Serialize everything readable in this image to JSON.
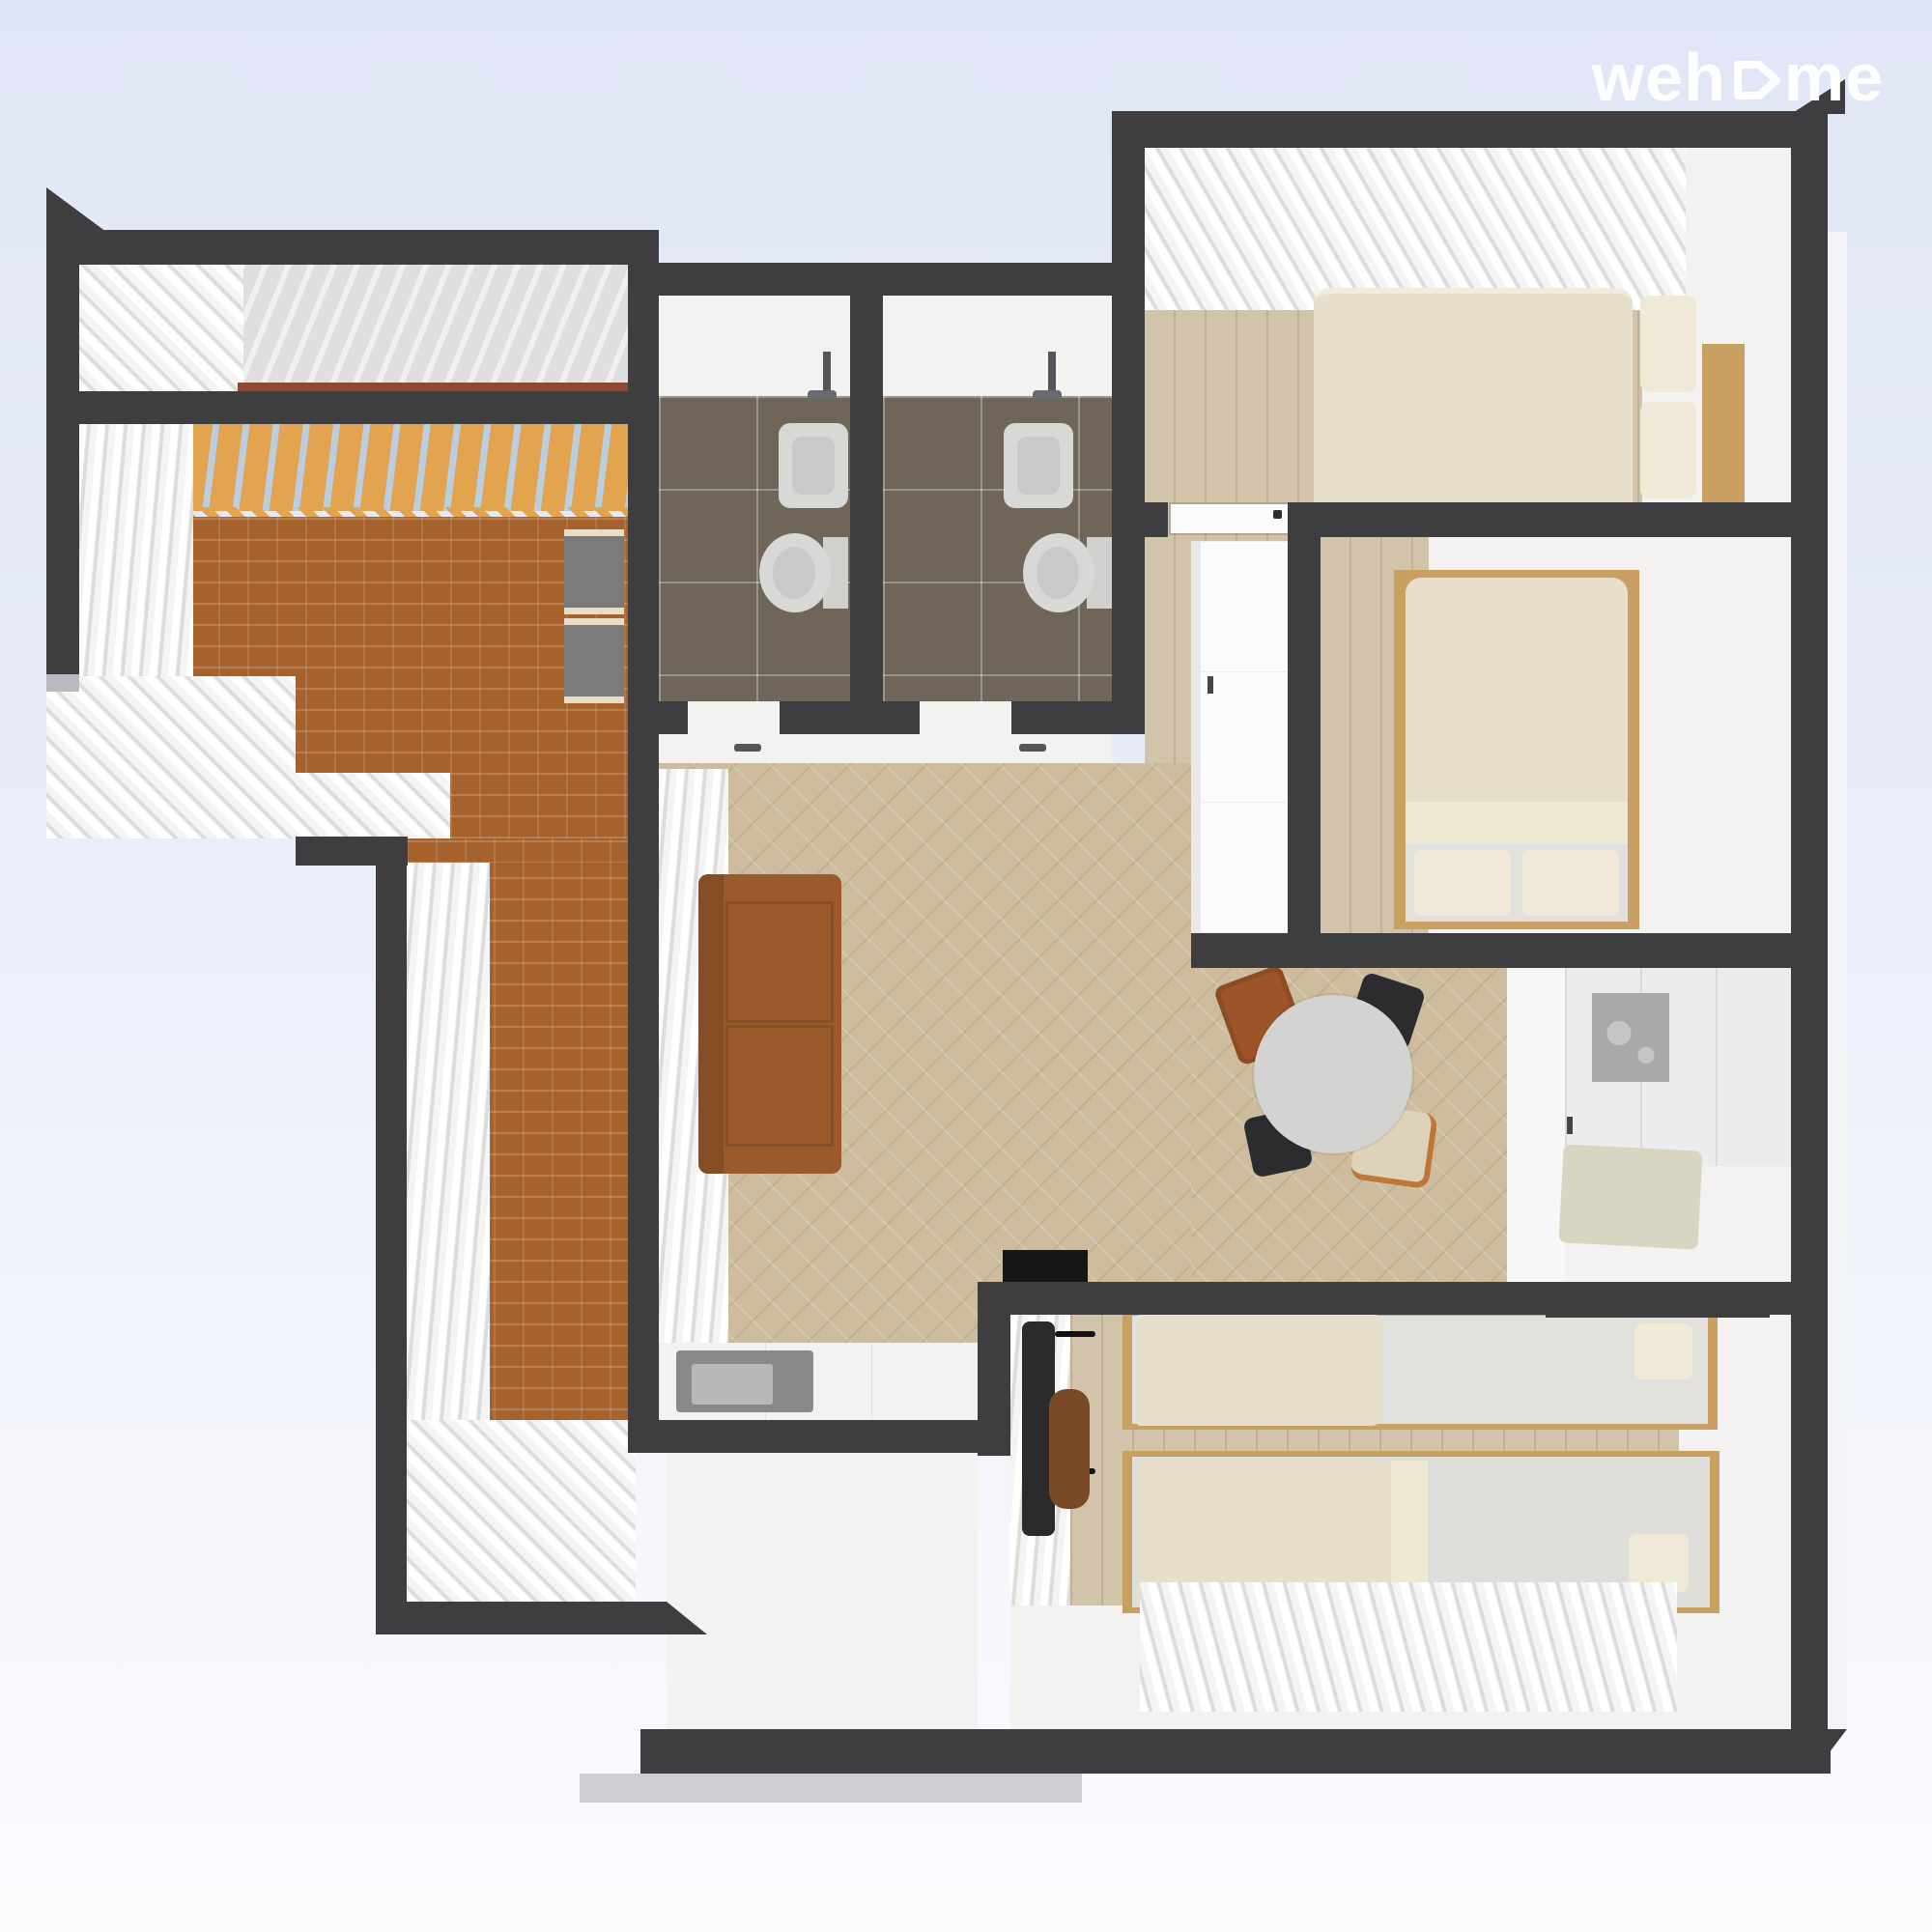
{
  "logo": {
    "part1": "weh",
    "part2": "me"
  },
  "palette": {
    "bg-top": "#e1e6f6",
    "bg-bottom": "#fbfcfe",
    "logo": "#ffffff",
    "wall": "#3e3e41",
    "wall-light": "#b9bac1",
    "floor-white": "#f3f2f0",
    "floor-gray": "#dfdfdf",
    "wood": "#d2c4ab",
    "herringbone": "#cdbd9e",
    "brick": "#a5622c",
    "awning-orange": "#e2a44e",
    "awning-blue": "#b9cedf",
    "tile": "#6f6558",
    "porcelain": "#d8d8d6",
    "curtain-hi": "#ffffff",
    "curtain-lo": "#dcdcdc",
    "sofa": "#9a5a2c",
    "sofa-dark": "#854d24",
    "bed-cream": "#e7dfcb",
    "mattress": "#e1e0dd",
    "pillow": "#f0e9d8",
    "bed-frame": "#c9a061",
    "table": "#d3d3d1",
    "chair-black": "#2c2c2e",
    "chair-brown": "#9d5429",
    "chair-tan": "#ded2b8",
    "chair-orange": "#c0763a",
    "closet": "#fbfbfb",
    "cabinet": "#d8d5c2",
    "art": "#a9a9a7",
    "sink": "#87898b",
    "sink-basin": "#b7b9bb",
    "bench": "#7b7b7b",
    "bench-trim": "#e9dec5",
    "rail": "#8a4a33",
    "mat": "#161616",
    "coat": "#2b2b2b",
    "bag-brown": "#7a4a28"
  }
}
